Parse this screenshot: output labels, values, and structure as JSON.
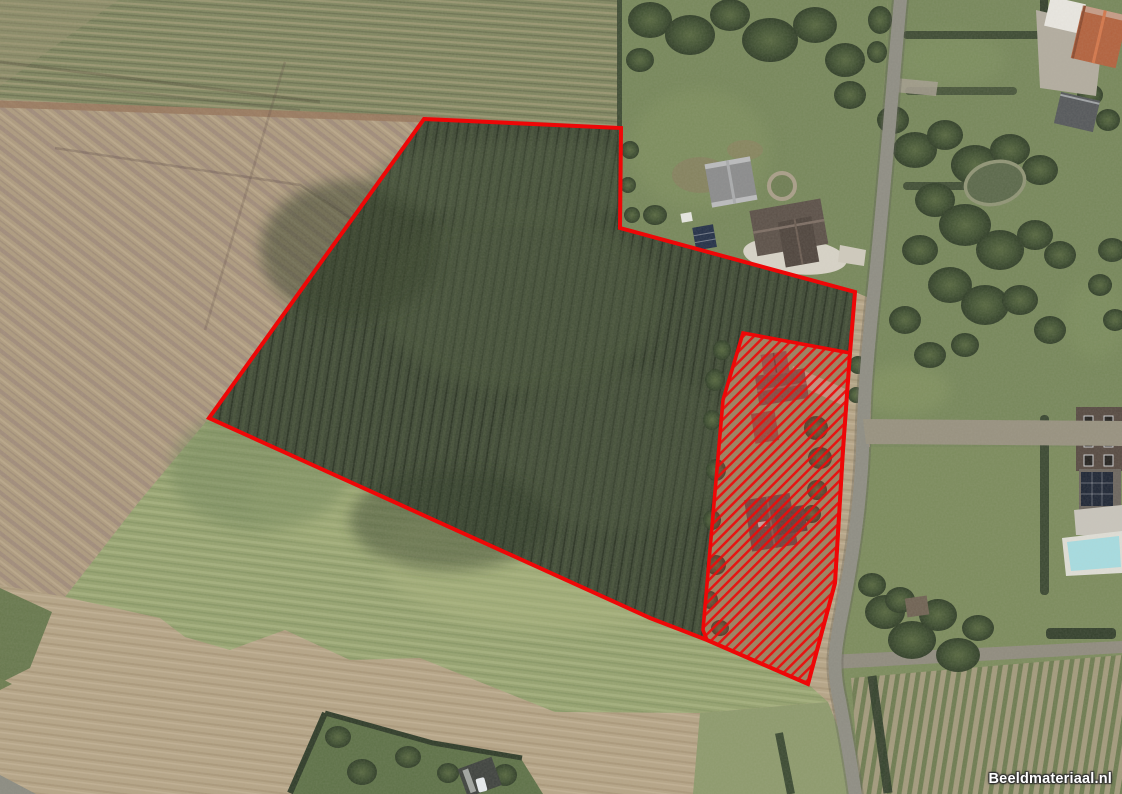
{
  "map": {
    "source_watermark": {
      "text": "Beeldmateriaal.nl",
      "color": "#ffffff"
    },
    "overlay_colors": {
      "outline": "#ee0707",
      "hatch-line": "#ec0b0b"
    },
    "parcels": {
      "main_outline_points": "424,119 621,128 620,228 855,292 850,353 843,450 835,583 808,684 707,640 650,618 209,418",
      "hatched_area_points": "743,333 850,353 843,450 835,583 808,684 707,640 703,630 723,400"
    },
    "terrain_palette": {
      "plowed-field": "#ad9a7e",
      "stubble-field": "#b5a486",
      "field-green-band": "#7f855f",
      "crop-field": "#3c4733",
      "grass-field": "#95a26f",
      "lawn": "#76875a",
      "trees": "#3f5033",
      "road": "#8e8d83",
      "gravel": "#d7d3c7",
      "roof-orange": "#b2613d",
      "roof-dark": "#564a42",
      "pool": "#a6dce1"
    }
  }
}
